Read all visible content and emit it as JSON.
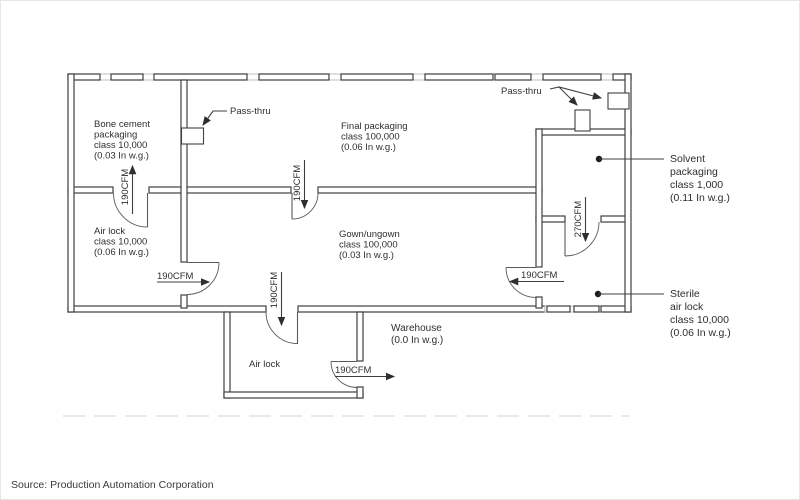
{
  "colors": {
    "wall": "#3f3f3f",
    "text": "#2f2f2f",
    "hatch_gap": "#c6c6c6",
    "dashed_line": "#dcdcdc"
  },
  "rooms": {
    "bone_cement": {
      "lines": [
        "Bone cement",
        "packaging",
        "class 10,000",
        "(0.03 In w.g.)"
      ]
    },
    "final_packaging": {
      "lines": [
        "Final packaging",
        "class 100,000",
        "(0.06 In w.g.)"
      ]
    },
    "air_lock_west": {
      "lines": [
        "Air lock",
        "class 10,000",
        "(0.06 In w.g.)"
      ]
    },
    "gown_ungown": {
      "lines": [
        "Gown/ungown",
        "class 100,000",
        "(0.03 In w.g.)"
      ]
    },
    "air_lock_annex": {
      "lines": [
        "Air lock"
      ]
    },
    "warehouse": {
      "lines": [
        "Warehouse",
        "(0.0 In w.g.)"
      ]
    },
    "solvent_packaging": {
      "lines": [
        "Solvent",
        "packaging",
        "class 1,000",
        "(0.11 In w.g.)"
      ]
    },
    "sterile_air_lock": {
      "lines": [
        "Sterile",
        "air lock",
        "class 10,000",
        "(0.06 In w.g.)"
      ]
    }
  },
  "airflow": {
    "bone_cement_door": "190CFM",
    "final_to_gown_door": "190CFM",
    "airlock_west_door": "190CFM",
    "gown_to_annex_door": "190CFM",
    "annex_to_warehouse_door": "190CFM",
    "sterile_to_gown_door": "190CFM",
    "solvent_to_sterile_door": "270CFM"
  },
  "passthru": {
    "left_label": "Pass-thru",
    "right_label": "Pass-thru"
  },
  "source": "Source: Production Automation Corporation"
}
